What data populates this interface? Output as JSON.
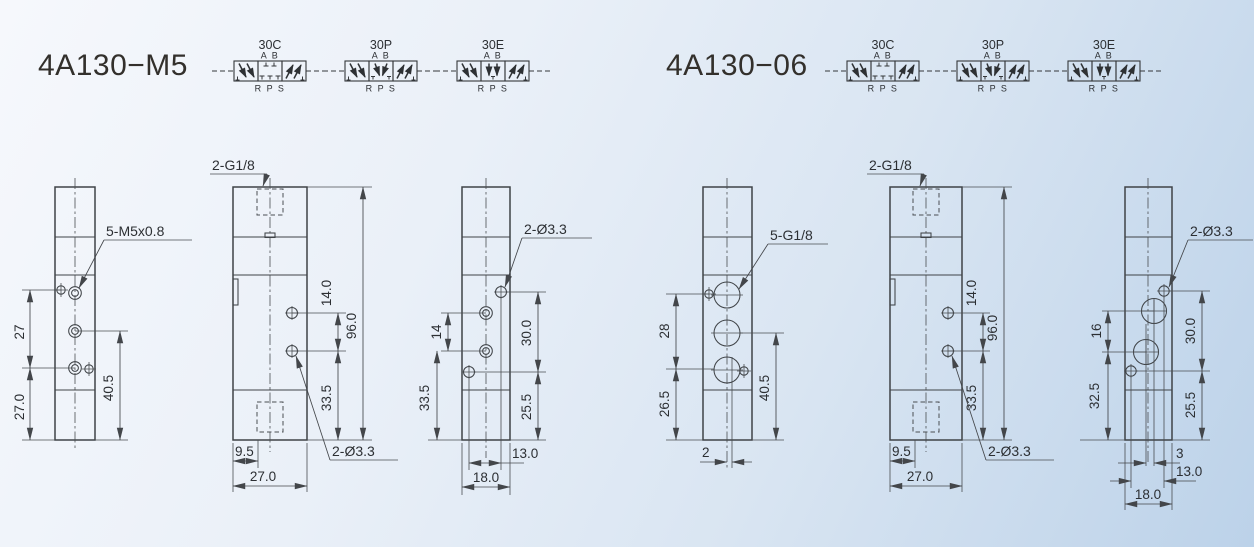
{
  "page": {
    "background_top": "#f6f8fc",
    "background_bottom": "#bcd2e9",
    "line_color": "#3f4347",
    "text_color": "#2c2f33"
  },
  "groups": [
    {
      "title": "4A130−M5",
      "symbols": [
        {
          "code": "30C",
          "top_ports": "A  B",
          "bottom_ports": "R P S"
        },
        {
          "code": "30P",
          "top_ports": "A  B",
          "bottom_ports": "R P S"
        },
        {
          "code": "30E",
          "top_ports": "A  B",
          "bottom_ports": "R P S"
        }
      ],
      "views": {
        "front": {
          "callout": "5-M5x0.8",
          "dim_port_pitch": "27",
          "dim_bottom_port": "27.0",
          "dim_right": "40.5"
        },
        "side": {
          "callout_top": "2-G1/8",
          "callout_holes": "2-Ø3.3",
          "dim_hole_pitch": "14.0",
          "dim_height": "96.0",
          "dim_hole_bottom": "33.5",
          "dim_port_offset": "9.5",
          "dim_width": "27.0"
        },
        "back": {
          "callout_holes": "2-Ø3.3",
          "dim_port_pitch": "14",
          "dim_port_bottom": "33.5",
          "dim_hole_pitch": "30.0",
          "dim_hole_bottom": "25.5",
          "dim_hole_span": "13.0",
          "dim_width": "18.0"
        }
      }
    },
    {
      "title": "4A130−06",
      "symbols": [
        {
          "code": "30C",
          "top_ports": "A  B",
          "bottom_ports": "R P S"
        },
        {
          "code": "30P",
          "top_ports": "A  B",
          "bottom_ports": "R P S"
        },
        {
          "code": "30E",
          "top_ports": "A  B",
          "bottom_ports": "R P S"
        }
      ],
      "views": {
        "front": {
          "callout": "5-G1/8",
          "dim_port_pitch": "28",
          "dim_bottom_port": "26.5",
          "dim_right": "40.5",
          "dim_stagger": "2"
        },
        "side": {
          "callout_top": "2-G1/8",
          "callout_holes": "2-Ø3.3",
          "dim_hole_pitch": "14.0",
          "dim_height": "96.0",
          "dim_hole_bottom": "33.5",
          "dim_port_offset": "9.5",
          "dim_width": "27.0"
        },
        "back": {
          "callout_holes": "2-Ø3.3",
          "dim_port_pitch": "16",
          "dim_port_bottom": "32.5",
          "dim_hole_pitch": "30.0",
          "dim_hole_bottom": "25.5",
          "dim_stagger": "3",
          "dim_hole_span": "13.0",
          "dim_width": "18.0"
        }
      }
    }
  ]
}
